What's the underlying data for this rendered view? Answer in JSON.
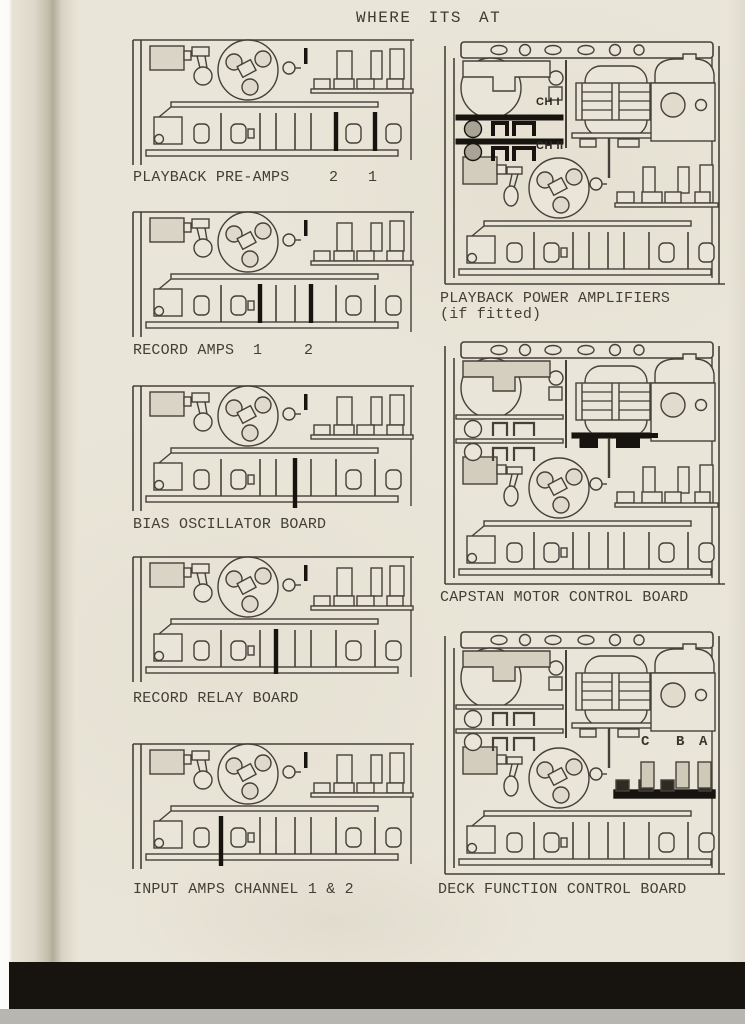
{
  "page": {
    "title": "WHERE ITS AT"
  },
  "figures": {
    "left": [
      {
        "caption": "PLAYBACK PRE-AMPS",
        "slot_markers": [
          "2",
          "1"
        ]
      },
      {
        "caption": "RECORD AMPS",
        "slot_markers": [
          "1",
          "2"
        ]
      },
      {
        "caption": "BIAS OSCILLATOR BOARD",
        "slot_markers": []
      },
      {
        "caption": "RECORD RELAY BOARD",
        "slot_markers": []
      },
      {
        "caption": "INPUT AMPS CHANNEL 1 & 2",
        "slot_markers": []
      }
    ],
    "right": [
      {
        "caption": "PLAYBACK POWER AMPLIFIERS",
        "caption_line2": "(if fitted)",
        "channel_labels": [
          "CH I",
          "CH II"
        ]
      },
      {
        "caption": "CAPSTAN MOTOR CONTROL BOARD"
      },
      {
        "caption": "DECK FUNCTION CONTROL BOARD",
        "board_labels": [
          "C",
          "B",
          "A"
        ]
      }
    ]
  },
  "colors": {
    "paper": "#e9e5d8",
    "ink": "#45413a",
    "highlight": "#17140f",
    "shade": "#d5cfc0",
    "footer_bar": "#17140f"
  }
}
